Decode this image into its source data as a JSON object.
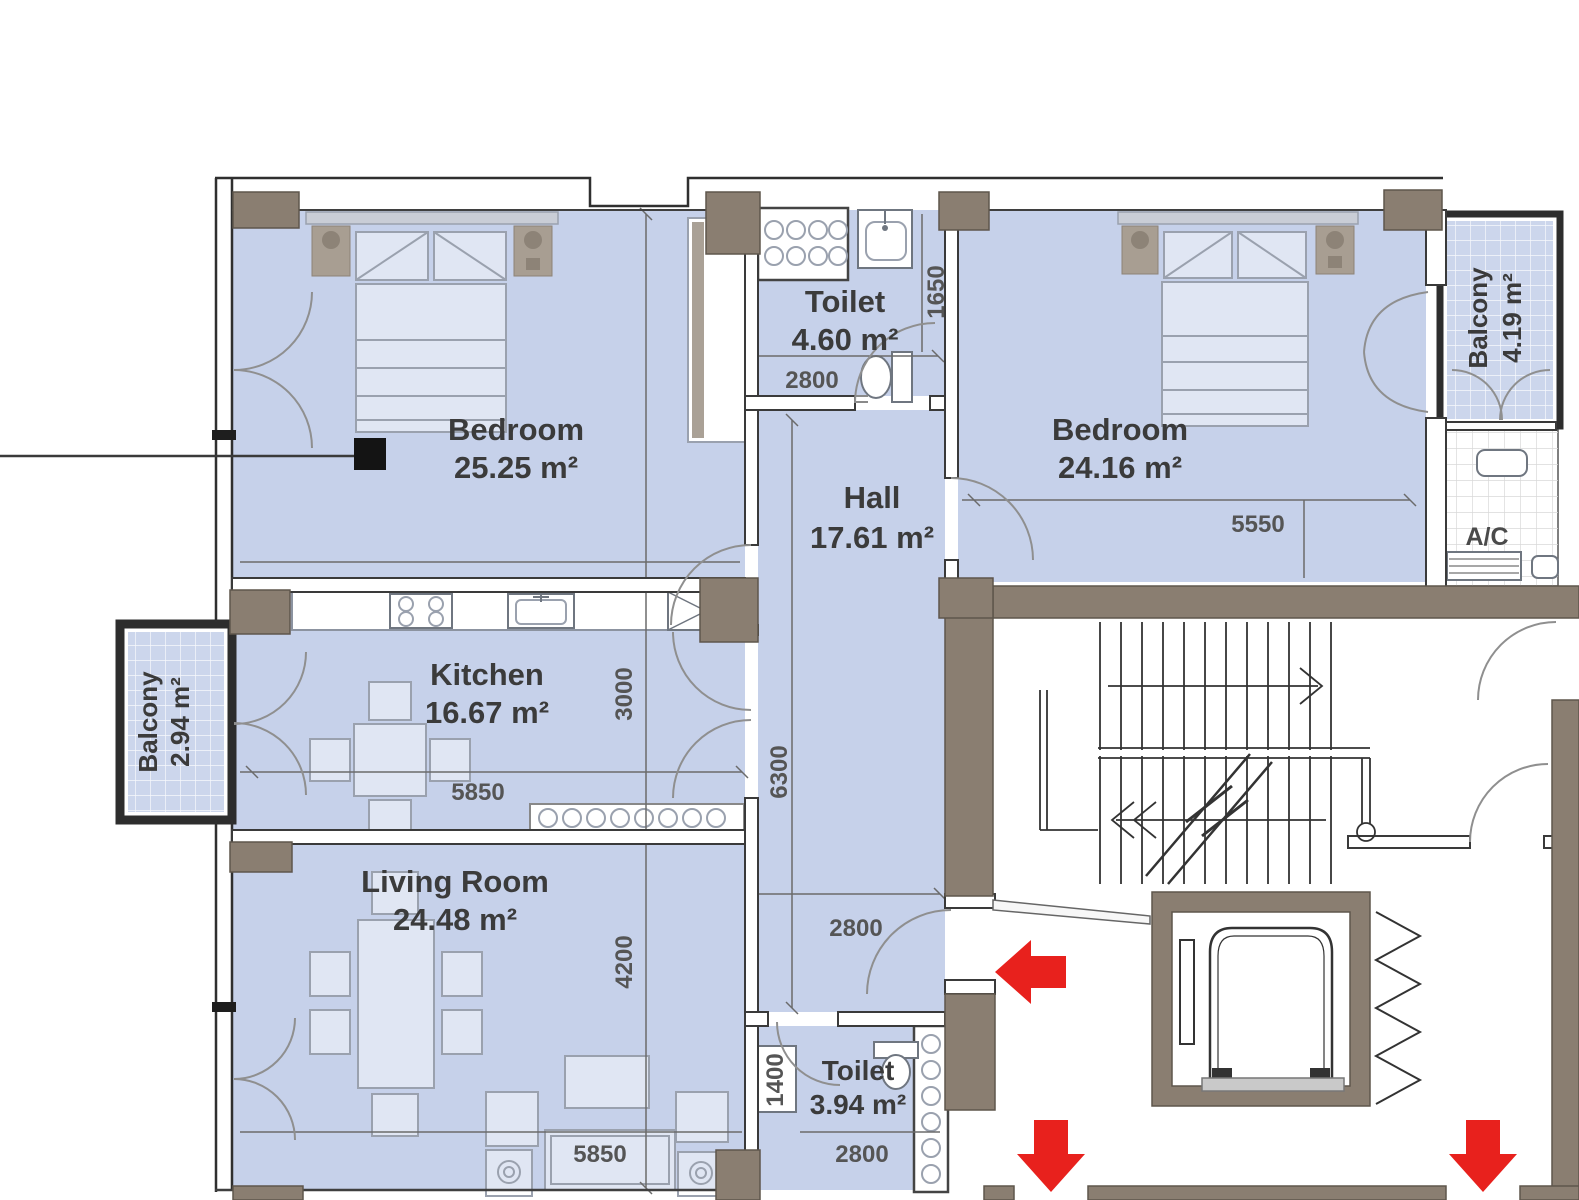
{
  "plan": {
    "rooms": {
      "bedroom1": {
        "name": "Bedroom",
        "area": "25.25 m²"
      },
      "toilet1": {
        "name": "Toilet",
        "area": "4.60 m²"
      },
      "bedroom2": {
        "name": "Bedroom",
        "area": "24.16 m²"
      },
      "hall": {
        "name": "Hall",
        "area": "17.61 m²"
      },
      "kitchen": {
        "name": "Kitchen",
        "area": "16.67 m²"
      },
      "living_room": {
        "name": "Living Room",
        "area": "24.48 m²"
      },
      "toilet2": {
        "name": "Toilet",
        "area": "3.94 m²"
      },
      "balcony_left": {
        "name": "Balcony",
        "area": "2.94 m²"
      },
      "balcony_right": {
        "name": "Balcony",
        "area": "4.19 m²"
      },
      "ac_zone": {
        "name": "A/C"
      }
    },
    "dimensions_mm": {
      "toilet1_width": "2800",
      "toilet1_depth": "1650",
      "bedroom2_width": "5550",
      "kitchen_depth": "3000",
      "kitchen_width": "5850",
      "hall_depth": "6300",
      "hall_width": "2800",
      "living_depth": "4200",
      "living_width": "5850",
      "toilet2_depth": "1400",
      "toilet2_width": "2800"
    },
    "colors": {
      "room_fill": "#c6d1ea",
      "wall_brown": "#8a7e71",
      "arrow_red": "#e8211d"
    }
  }
}
